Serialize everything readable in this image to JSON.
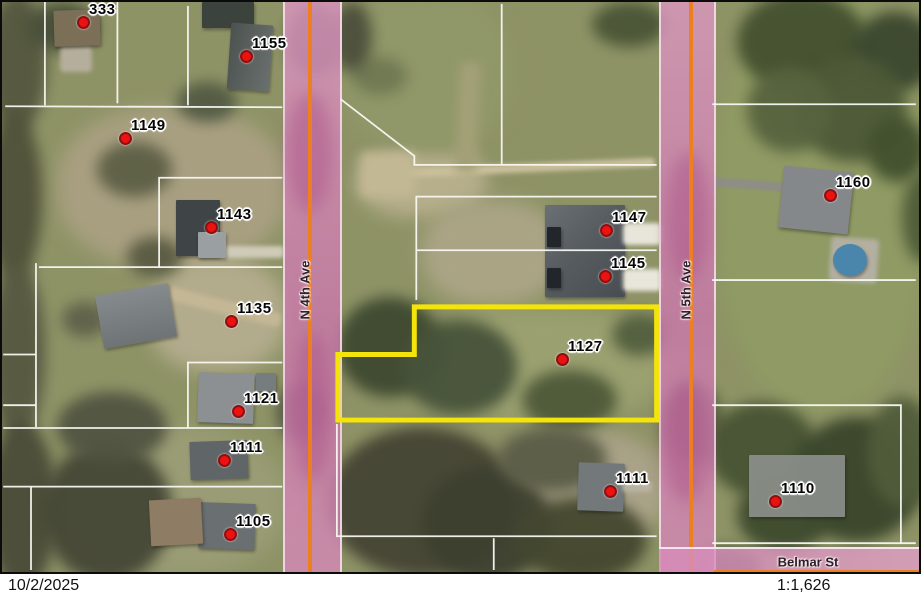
{
  "map": {
    "streets": {
      "n4th": "N 4th Ave",
      "n5th": "N 5th Ave",
      "belmar": "Belmar St"
    },
    "labels": [
      {
        "text": "333"
      },
      {
        "text": "1155"
      },
      {
        "text": "1149"
      },
      {
        "text": "1143"
      },
      {
        "text": "1135"
      },
      {
        "text": "1121"
      },
      {
        "text": "1111"
      },
      {
        "text": "1105"
      },
      {
        "text": "1147"
      },
      {
        "text": "1145"
      },
      {
        "text": "1127"
      },
      {
        "text": "1160"
      },
      {
        "text": "1111"
      },
      {
        "text": "1110"
      }
    ],
    "highlighted_parcel": "1127",
    "colors": {
      "road_pink": "#d08ab8",
      "centerline_orange": "#ee7f1e",
      "highlight_yellow": "#f4e40a",
      "marker_red": "#ec1212",
      "parcel_line_white": "#f8f8f2"
    }
  },
  "statusbar": {
    "date": "10/2/2025",
    "scale": "1:1,626"
  }
}
